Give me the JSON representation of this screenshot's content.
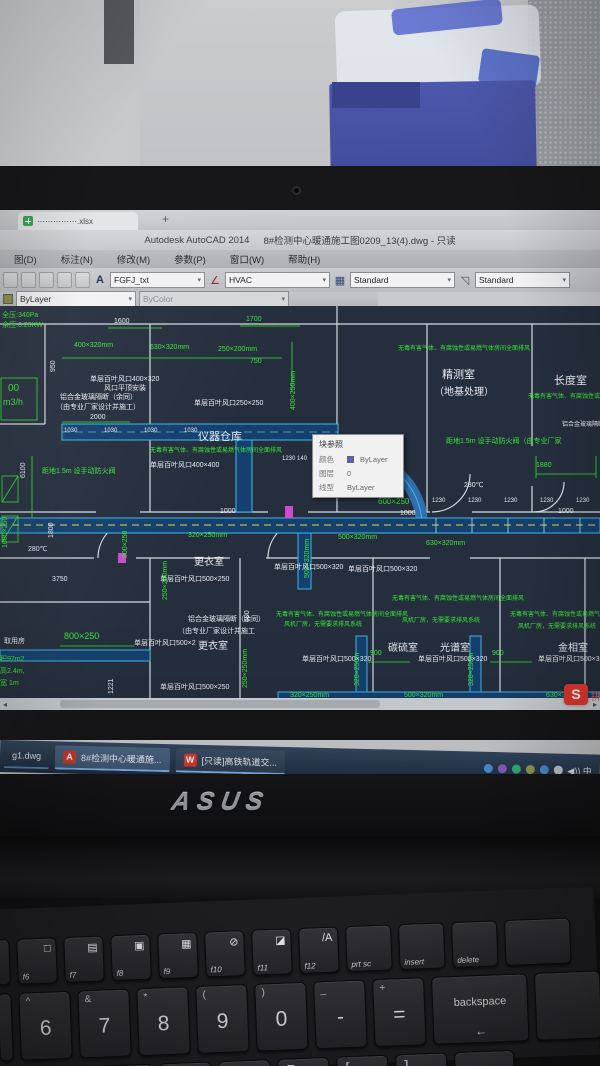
{
  "background_tab": {
    "label": "⋯⋯⋯⋯⋯.xlsx",
    "plus": "+"
  },
  "window": {
    "app_title": "Autodesk AutoCAD 2014",
    "doc_title": "8#检测中心暖通施工图0209_13(4).dwg - 只读",
    "menus": [
      "图(D)",
      "标注(N)",
      "修改(M)",
      "参数(P)",
      "窗口(W)",
      "帮助(H)"
    ],
    "toolbar": {
      "text_style": "FGFJ_txt",
      "dim_style": "HVAC",
      "table_style": "Standard",
      "mleader_style": "Standard",
      "color_value": "ByLayer",
      "linetype_value": "ByColor",
      "icons": {
        "text_style": "A",
        "dim_style": "∠",
        "table_style": "▦",
        "mleader": "◹",
        "chevron": "▾"
      }
    }
  },
  "tooltip": {
    "title": "块参照",
    "swatch_color": "#5560c8",
    "rows": [
      {
        "label": "颜色",
        "value": "ByLayer",
        "swatch": true
      },
      {
        "label": "图层",
        "value": "0",
        "swatch": false
      },
      {
        "label": "线型",
        "value": "ByLayer",
        "swatch": false
      }
    ]
  },
  "drawing": {
    "palette": {
      "g": "#39e639",
      "w": "#e9ebf1"
    },
    "labels": [
      {
        "t": "全压:340Pa",
        "x": 2,
        "y": 6,
        "c": "g"
      },
      {
        "t": "余压:0.28KW",
        "x": 2,
        "y": 16,
        "c": "g"
      },
      {
        "t": "1600",
        "x": 114,
        "y": 12,
        "c": "w"
      },
      {
        "t": "1700",
        "x": 246,
        "y": 10,
        "c": "g"
      },
      {
        "t": "400×320mm",
        "x": 74,
        "y": 36,
        "c": "g"
      },
      {
        "t": "630×320mm",
        "x": 150,
        "y": 38,
        "c": "g"
      },
      {
        "t": "250×200mm",
        "x": 218,
        "y": 40,
        "c": "g"
      },
      {
        "t": "950",
        "x": 50,
        "y": 66,
        "c": "w",
        "r": 1
      },
      {
        "t": "750",
        "x": 250,
        "y": 52,
        "c": "g"
      },
      {
        "t": "400×250mm",
        "x": 290,
        "y": 104,
        "c": "g",
        "r": 1
      },
      {
        "t": "单层百叶风口400×320",
        "x": 90,
        "y": 70,
        "c": "w"
      },
      {
        "t": "风口平顶安装",
        "x": 104,
        "y": 79,
        "c": "w"
      },
      {
        "t": "铝合金玻璃隔断（余同）",
        "x": 60,
        "y": 88,
        "c": "w"
      },
      {
        "t": "（由专业厂家设计并施工）",
        "x": 56,
        "y": 98,
        "c": "w"
      },
      {
        "t": "00",
        "x": 8,
        "y": 78,
        "c": "g",
        "s": 10
      },
      {
        "t": "m3/h",
        "x": 3,
        "y": 92,
        "c": "g",
        "s": 9
      },
      {
        "t": "单层百叶风口250×250",
        "x": 194,
        "y": 94,
        "c": "w"
      },
      {
        "t": "2000",
        "x": 90,
        "y": 108,
        "c": "w"
      },
      {
        "t": "仪器仓库",
        "x": 198,
        "y": 126,
        "c": "w",
        "s": 11
      },
      {
        "t": "无毒有害气体、有腐蚀性或易燃气体房间全面排风",
        "x": 150,
        "y": 142,
        "c": "g",
        "s": 6
      },
      {
        "t": "单层百叶风口400×400",
        "x": 150,
        "y": 156,
        "c": "w"
      },
      {
        "t": "1230  140",
        "x": 282,
        "y": 150,
        "c": "w",
        "s": 6
      },
      {
        "t": "6100",
        "x": 20,
        "y": 172,
        "c": "w",
        "r": 1
      },
      {
        "t": "距地1.5m 设手动防火阀",
        "x": 42,
        "y": 162,
        "c": "g"
      },
      {
        "t": "1030",
        "x": 64,
        "y": 122,
        "c": "w",
        "s": 6
      },
      {
        "t": "1030",
        "x": 104,
        "y": 122,
        "c": "w",
        "s": 6
      },
      {
        "t": "1030",
        "x": 144,
        "y": 122,
        "c": "w",
        "s": 6
      },
      {
        "t": "1030",
        "x": 184,
        "y": 122,
        "c": "w",
        "s": 6
      },
      {
        "t": "精测室",
        "x": 442,
        "y": 64,
        "c": "w",
        "s": 11
      },
      {
        "t": "（地基处理）",
        "x": 434,
        "y": 82,
        "c": "w",
        "s": 10
      },
      {
        "t": "无毒有害气体、有腐蚀性或易燃气体房间全面排风",
        "x": 398,
        "y": 40,
        "c": "g",
        "s": 6
      },
      {
        "t": "长度室",
        "x": 554,
        "y": 70,
        "c": "w",
        "s": 11
      },
      {
        "t": "无毒有害气体、有腐蚀性或易燃",
        "x": 528,
        "y": 88,
        "c": "g",
        "s": 6
      },
      {
        "t": "铝合金玻璃隔断（",
        "x": 562,
        "y": 116,
        "c": "w",
        "s": 6
      },
      {
        "t": "距地1.5m 设手动防火阀（由专业厂家",
        "x": 446,
        "y": 132,
        "c": "g"
      },
      {
        "t": "1880",
        "x": 536,
        "y": 156,
        "c": "g"
      },
      {
        "t": "280℃",
        "x": 464,
        "y": 176,
        "c": "w"
      },
      {
        "t": "1230",
        "x": 432,
        "y": 192,
        "c": "w",
        "s": 6
      },
      {
        "t": "1230",
        "x": 468,
        "y": 192,
        "c": "w",
        "s": 6
      },
      {
        "t": "1230",
        "x": 504,
        "y": 192,
        "c": "w",
        "s": 6
      },
      {
        "t": "1230",
        "x": 540,
        "y": 192,
        "c": "w",
        "s": 6
      },
      {
        "t": "1230",
        "x": 576,
        "y": 192,
        "c": "w",
        "s": 6
      },
      {
        "t": "1000",
        "x": 220,
        "y": 202,
        "c": "w"
      },
      {
        "t": "1000",
        "x": 400,
        "y": 204,
        "c": "w"
      },
      {
        "t": "1000",
        "x": 558,
        "y": 202,
        "c": "w"
      },
      {
        "t": "320×250mm",
        "x": 188,
        "y": 226,
        "c": "g"
      },
      {
        "t": "500×320mm",
        "x": 338,
        "y": 228,
        "c": "g"
      },
      {
        "t": "500×320mm",
        "x": 304,
        "y": 272,
        "c": "g",
        "r": 1
      },
      {
        "t": "630×320mm",
        "x": 426,
        "y": 234,
        "c": "g"
      },
      {
        "t": "600×250",
        "x": 378,
        "y": 192,
        "c": "g",
        "s": 8
      },
      {
        "t": "更衣室",
        "x": 194,
        "y": 252,
        "c": "w",
        "s": 10
      },
      {
        "t": "单层百叶风口500×320",
        "x": 274,
        "y": 258,
        "c": "w"
      },
      {
        "t": "单层百叶风口500×320",
        "x": 348,
        "y": 260,
        "c": "w"
      },
      {
        "t": "单层百叶风口500×250",
        "x": 160,
        "y": 270,
        "c": "w"
      },
      {
        "t": "1000×250",
        "x": 2,
        "y": 242,
        "c": "g",
        "r": 1
      },
      {
        "t": "1800",
        "x": 48,
        "y": 232,
        "c": "w",
        "r": 1
      },
      {
        "t": "800×250",
        "x": 122,
        "y": 252,
        "c": "g",
        "r": 1
      },
      {
        "t": "280℃",
        "x": 28,
        "y": 240,
        "c": "w"
      },
      {
        "t": "3750",
        "x": 52,
        "y": 270,
        "c": "w"
      },
      {
        "t": "250×250mm",
        "x": 162,
        "y": 294,
        "c": "g",
        "r": 1
      },
      {
        "t": "铝合金玻璃隔断（余同）",
        "x": 188,
        "y": 310,
        "c": "w"
      },
      {
        "t": "（由专业厂家设计并施工",
        "x": 178,
        "y": 322,
        "c": "w"
      },
      {
        "t": "更衣室",
        "x": 198,
        "y": 336,
        "c": "w",
        "s": 10
      },
      {
        "t": "无毒有害气体、有腐蚀性或易燃气体房间全面排风",
        "x": 276,
        "y": 306,
        "c": "g",
        "s": 6
      },
      {
        "t": "风机厂房，无需要求排风系统",
        "x": 284,
        "y": 316,
        "c": "g",
        "s": 6
      },
      {
        "t": "碳硫室",
        "x": 388,
        "y": 338,
        "c": "w",
        "s": 10
      },
      {
        "t": "单层百叶风口500×320",
        "x": 302,
        "y": 350,
        "c": "w"
      },
      {
        "t": "单层百叶风口500×250",
        "x": 160,
        "y": 378,
        "c": "w"
      },
      {
        "t": "500",
        "x": 244,
        "y": 316,
        "c": "w",
        "r": 1
      },
      {
        "t": "250×250mm",
        "x": 242,
        "y": 382,
        "c": "g",
        "r": 1
      },
      {
        "t": "无毒有害气体、有腐蚀性或易燃气体房间全面排风",
        "x": 392,
        "y": 290,
        "c": "g",
        "s": 6
      },
      {
        "t": "风机厂房，无需要求排风系统",
        "x": 402,
        "y": 312,
        "c": "g",
        "s": 6
      },
      {
        "t": "光谱室",
        "x": 440,
        "y": 338,
        "c": "w",
        "s": 10
      },
      {
        "t": "单层百叶风口500×320",
        "x": 418,
        "y": 350,
        "c": "w"
      },
      {
        "t": "900",
        "x": 370,
        "y": 344,
        "c": "g"
      },
      {
        "t": "900",
        "x": 492,
        "y": 344,
        "c": "g"
      },
      {
        "t": "无毒有害气体、有腐蚀性或易燃气体房间全面排风",
        "x": 510,
        "y": 306,
        "c": "g",
        "s": 6
      },
      {
        "t": "风机厂房，无需要求排风系统",
        "x": 518,
        "y": 318,
        "c": "g",
        "s": 6
      },
      {
        "t": "金相室",
        "x": 558,
        "y": 338,
        "c": "w",
        "s": 10
      },
      {
        "t": "单层百叶风口500×3",
        "x": 538,
        "y": 350,
        "c": "w"
      },
      {
        "t": "800×250",
        "x": 64,
        "y": 326,
        "c": "g",
        "s": 9
      },
      {
        "t": "取用房",
        "x": 4,
        "y": 332,
        "c": "w"
      },
      {
        "t": "单层百叶风口500×2",
        "x": 134,
        "y": 334,
        "c": "w"
      },
      {
        "t": "积97m2",
        "x": 0,
        "y": 350,
        "c": "g"
      },
      {
        "t": "高2.4m,",
        "x": 0,
        "y": 362,
        "c": "g"
      },
      {
        "t": "宽 1m",
        "x": 0,
        "y": 374,
        "c": "g"
      },
      {
        "t": "1221",
        "x": 108,
        "y": 388,
        "c": "w",
        "r": 1
      },
      {
        "t": "320×250mm",
        "x": 290,
        "y": 386,
        "c": "g"
      },
      {
        "t": "500×320mm",
        "x": 404,
        "y": 386,
        "c": "g"
      },
      {
        "t": "630×320mm",
        "x": 546,
        "y": 386,
        "c": "g"
      },
      {
        "t": "320×250m",
        "x": 354,
        "y": 380,
        "c": "g",
        "r": 1
      },
      {
        "t": "320×250m",
        "x": 468,
        "y": 380,
        "c": "g",
        "r": 1
      }
    ]
  },
  "scrollbar": {
    "left_arrow": "◂",
    "right_arrow": "▸"
  },
  "input_indicator": {
    "letter": "S",
    "extra": "拼"
  },
  "taskbar": {
    "items": [
      {
        "icon": "",
        "icon_bg": "",
        "label": "g1.dwg",
        "style": "plain"
      },
      {
        "icon": "A",
        "icon_bg": "#c83a2e",
        "label": "8#检测中心暖通施...",
        "style": "active"
      },
      {
        "icon": "W",
        "icon_bg": "#d43a30",
        "label": "[只读]高铁轨道交...",
        "style": ""
      }
    ],
    "tray_dots": [
      "#4a8fd4",
      "#8a5fc0",
      "#35b37a",
      "#98a050",
      "#4a8fd4",
      "#c8cbd0"
    ],
    "tray_text": "◀)) 中"
  },
  "laptop": {
    "brand": "ASUS"
  },
  "keyboard": {
    "function_row": [
      {
        "k": "",
        "w": 14
      },
      {
        "k": "f6",
        "g": "□",
        "w": 40
      },
      {
        "k": "f7",
        "g": "▤",
        "w": 40
      },
      {
        "k": "f8",
        "g": "▣",
        "w": 40
      },
      {
        "k": "f9",
        "g": "▦",
        "w": 40
      },
      {
        "k": "f10",
        "g": "⊘",
        "w": 40
      },
      {
        "k": "f11",
        "g": "◪",
        "w": 40
      },
      {
        "k": "f12",
        "g": "/A",
        "w": 40
      },
      {
        "k": "prt sc",
        "w": 46
      },
      {
        "k": "insert",
        "w": 46
      },
      {
        "k": "delete",
        "w": 46
      },
      {
        "k": "",
        "w": 66
      }
    ],
    "number_row": [
      {
        "m": "",
        "s": "",
        "w": 14
      },
      {
        "m": "6",
        "s": "^",
        "w": 52
      },
      {
        "m": "7",
        "s": "&",
        "w": 52
      },
      {
        "m": "8",
        "s": "*",
        "w": 52
      },
      {
        "m": "9",
        "s": "(",
        "w": 52
      },
      {
        "m": "0",
        "s": ")",
        "w": 52
      },
      {
        "m": "-",
        "s": "_",
        "w": 52
      },
      {
        "m": "=",
        "s": "+",
        "w": 52
      },
      {
        "m": "backspace",
        "s": "",
        "w": 96,
        "arrow": "←"
      },
      {
        "m": "",
        "s": "",
        "w": 66
      }
    ],
    "letter_row": [
      {
        "m": "T",
        "w": 34
      },
      {
        "m": "Y",
        "w": 52
      },
      {
        "m": "U",
        "w": 52
      },
      {
        "m": "I",
        "w": 52
      },
      {
        "m": "O",
        "w": 52
      },
      {
        "m": "P",
        "w": 52
      },
      {
        "m": "[",
        "w": 52
      },
      {
        "m": "]",
        "w": 52
      },
      {
        "m": "",
        "w": 60
      }
    ]
  }
}
